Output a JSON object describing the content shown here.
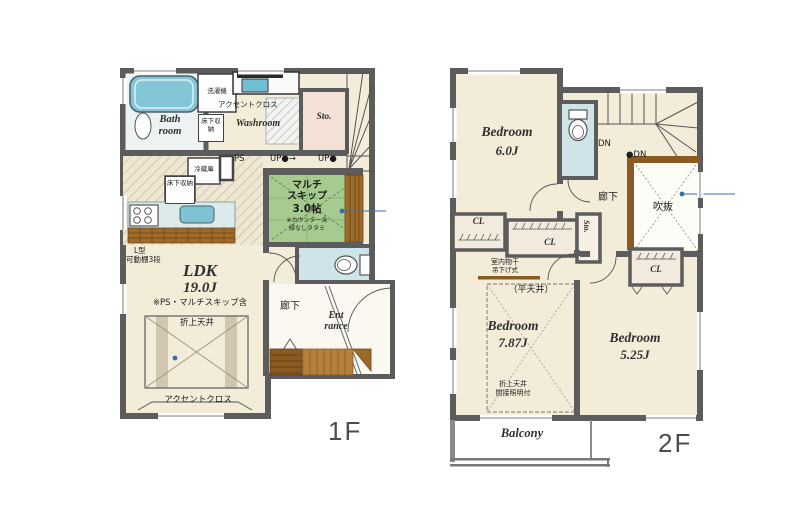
{
  "title": "2-story house floor plan",
  "colors": {
    "wall": "#5c5c5c",
    "floor_cream": "#f3ecd8",
    "tatami_green": "#a7cb8e",
    "water_blue": "#cfe4e8",
    "bathtub_blue": "#84c6d8",
    "wood_dark": "#8a5a20",
    "wood_mid": "#9d6a2a",
    "wood_light": "#b5803c",
    "storage_beige": "#f3e1d5",
    "closet_fill": "#f2ebdd",
    "annotation_blue": "#3a6ea8"
  },
  "floor1": {
    "label": "1F",
    "bath": {
      "name": "Bath room"
    },
    "laundry": {
      "name": "洗濯機"
    },
    "accent_cross_top": "アクセントクロス",
    "washroom": {
      "name": "Washroom",
      "underfloor_storage": "床下収納"
    },
    "storage": {
      "name": "Sto."
    },
    "pipe_space": "PS",
    "stairs_up_1": "UP●→",
    "stairs_up_2": "UP●",
    "kitchen": {
      "fridge": "冷蔵庫",
      "underfloor_storage": "床下収納",
      "shelf_line1": "L型",
      "shelf_line2": "可動棚3段"
    },
    "multi_skip": {
      "line1": "マルチ",
      "line2": "スキップ",
      "line3": "3.0帖",
      "note1": "※カウンター含",
      "note2": "縁なしタタミ"
    },
    "ldk": {
      "name": "LDK",
      "size": "19.0J",
      "note": "※PS・マルチスキップ含",
      "coffered_ceiling": "折上天井",
      "accent_cross": "アクセントクロス"
    },
    "hallway": {
      "name": "廊下"
    },
    "entrance": {
      "line1": "Ent",
      "line2": "rance"
    }
  },
  "floor2": {
    "label": "2F",
    "bedroom_6": {
      "name": "Bedroom",
      "size": "6.0J"
    },
    "stairs_down_1": "DN",
    "stairs_down_2": "●DN",
    "hallway": {
      "name": "廊下"
    },
    "void": {
      "name": "吹抜"
    },
    "closet_1": "CL",
    "closet_2": "CL",
    "closet_3": "CL",
    "storage": {
      "name": "Sto."
    },
    "drying": {
      "line1": "室内物干",
      "line2": "吊下げ式"
    },
    "bedroom_787": {
      "ceiling_note": "（平天井）",
      "name": "Bedroom",
      "size": "7.87J",
      "note1": "折上天井",
      "note2": "間接照明付"
    },
    "bedroom_525": {
      "name": "Bedroom",
      "size": "5.25J"
    },
    "balcony": {
      "name": "Balcony"
    }
  }
}
